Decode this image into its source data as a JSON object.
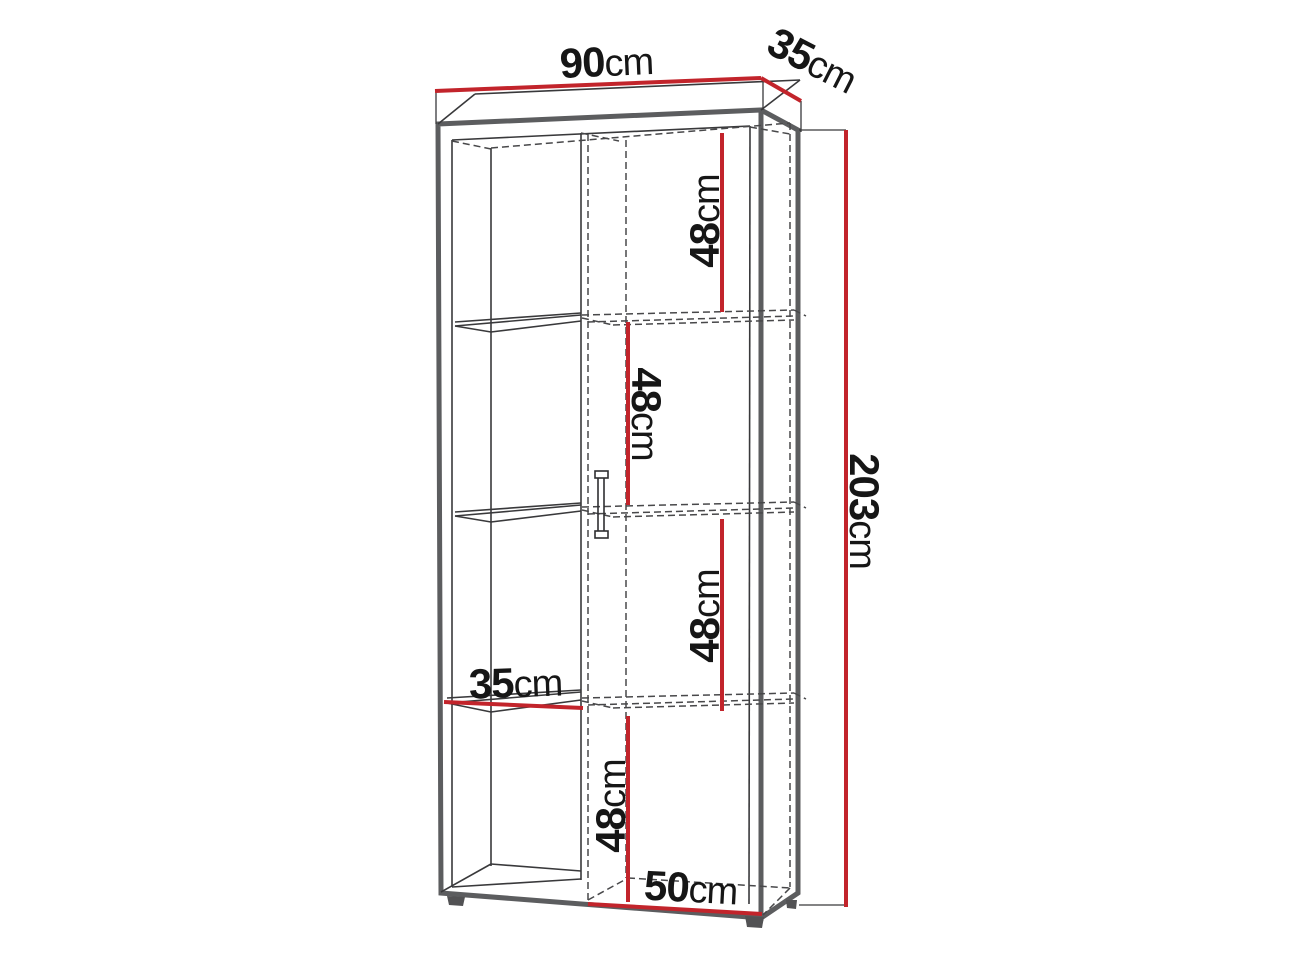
{
  "diagram": {
    "type": "furniture-dimension-diagram",
    "subject": "tall two-column cabinet with open shelves and door",
    "dimensions": {
      "width": {
        "num": "90",
        "unit": "cm"
      },
      "depth": {
        "num": "35",
        "unit": "cm"
      },
      "height": {
        "num": "203",
        "unit": "cm"
      },
      "compartment1": {
        "num": "48",
        "unit": "cm"
      },
      "compartment2": {
        "num": "48",
        "unit": "cm"
      },
      "compartment3": {
        "num": "48",
        "unit": "cm"
      },
      "compartment4": {
        "num": "48",
        "unit": "cm"
      },
      "shelf_width": {
        "num": "35",
        "unit": "cm"
      },
      "door_width": {
        "num": "50",
        "unit": "cm"
      }
    },
    "colors": {
      "dimension_line": "#c2242b",
      "outline": "#5c5d5f",
      "thin_line": "#39393b",
      "hidden_line": "#48484a",
      "label_text": "#161616",
      "background": "#ffffff"
    }
  }
}
